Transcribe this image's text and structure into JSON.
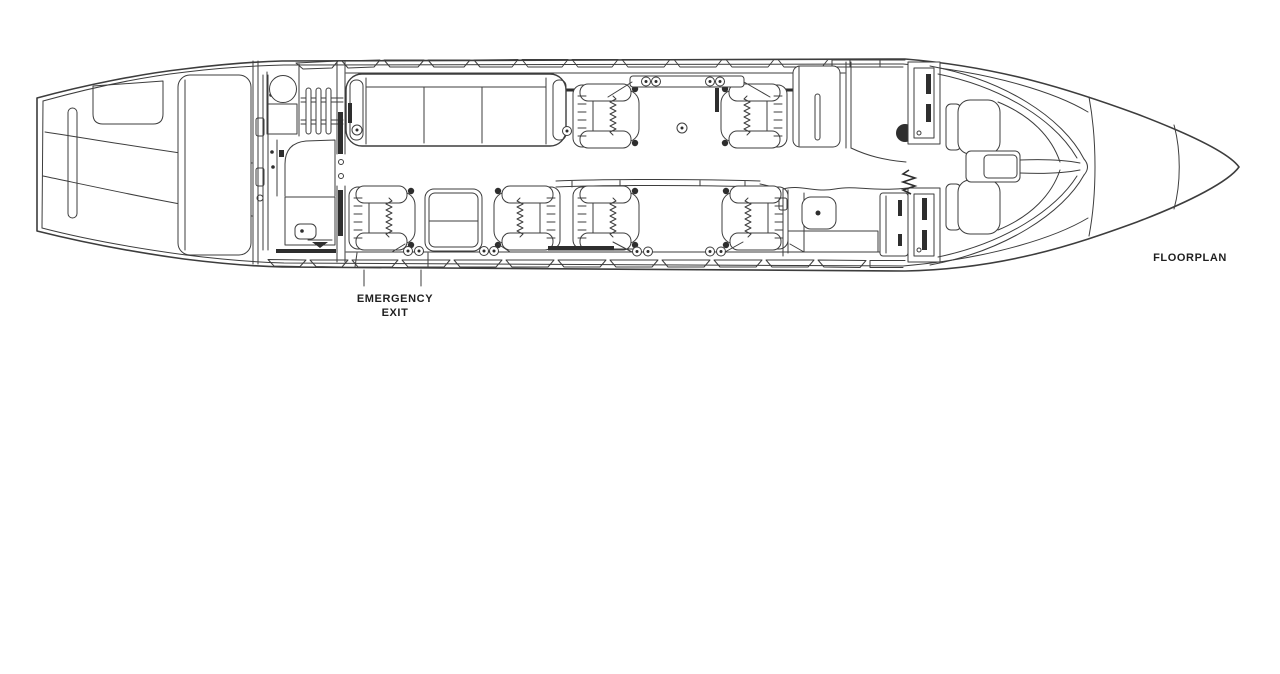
{
  "page": {
    "background_color": "#ffffff"
  },
  "diagram": {
    "kind": "business-jet cabin floorplan line drawing, side-entry top view",
    "line_color": "#3d3d3d",
    "dark_fill_color": "#2e2e2e",
    "labels": {
      "emergency_exit_line1": "EMERGENCY",
      "emergency_exit_line2": "EXIT",
      "floorplan": "FLOORPLAN"
    },
    "features": [
      "tail cone",
      "aft baggage door",
      "aft lavatory with round sink, wardrobe rack, vanity and toilet",
      "three-place divan",
      "six single club seats in facing pairs",
      "fold-out conference table",
      "over-wing emergency exit",
      "forward galley with sink and tall cabinet",
      "forward storage cabinet",
      "entry door",
      "cockpit bulkhead with divider curtain",
      "two crew seats with center pedestal",
      "windshield",
      "nose radome"
    ]
  }
}
